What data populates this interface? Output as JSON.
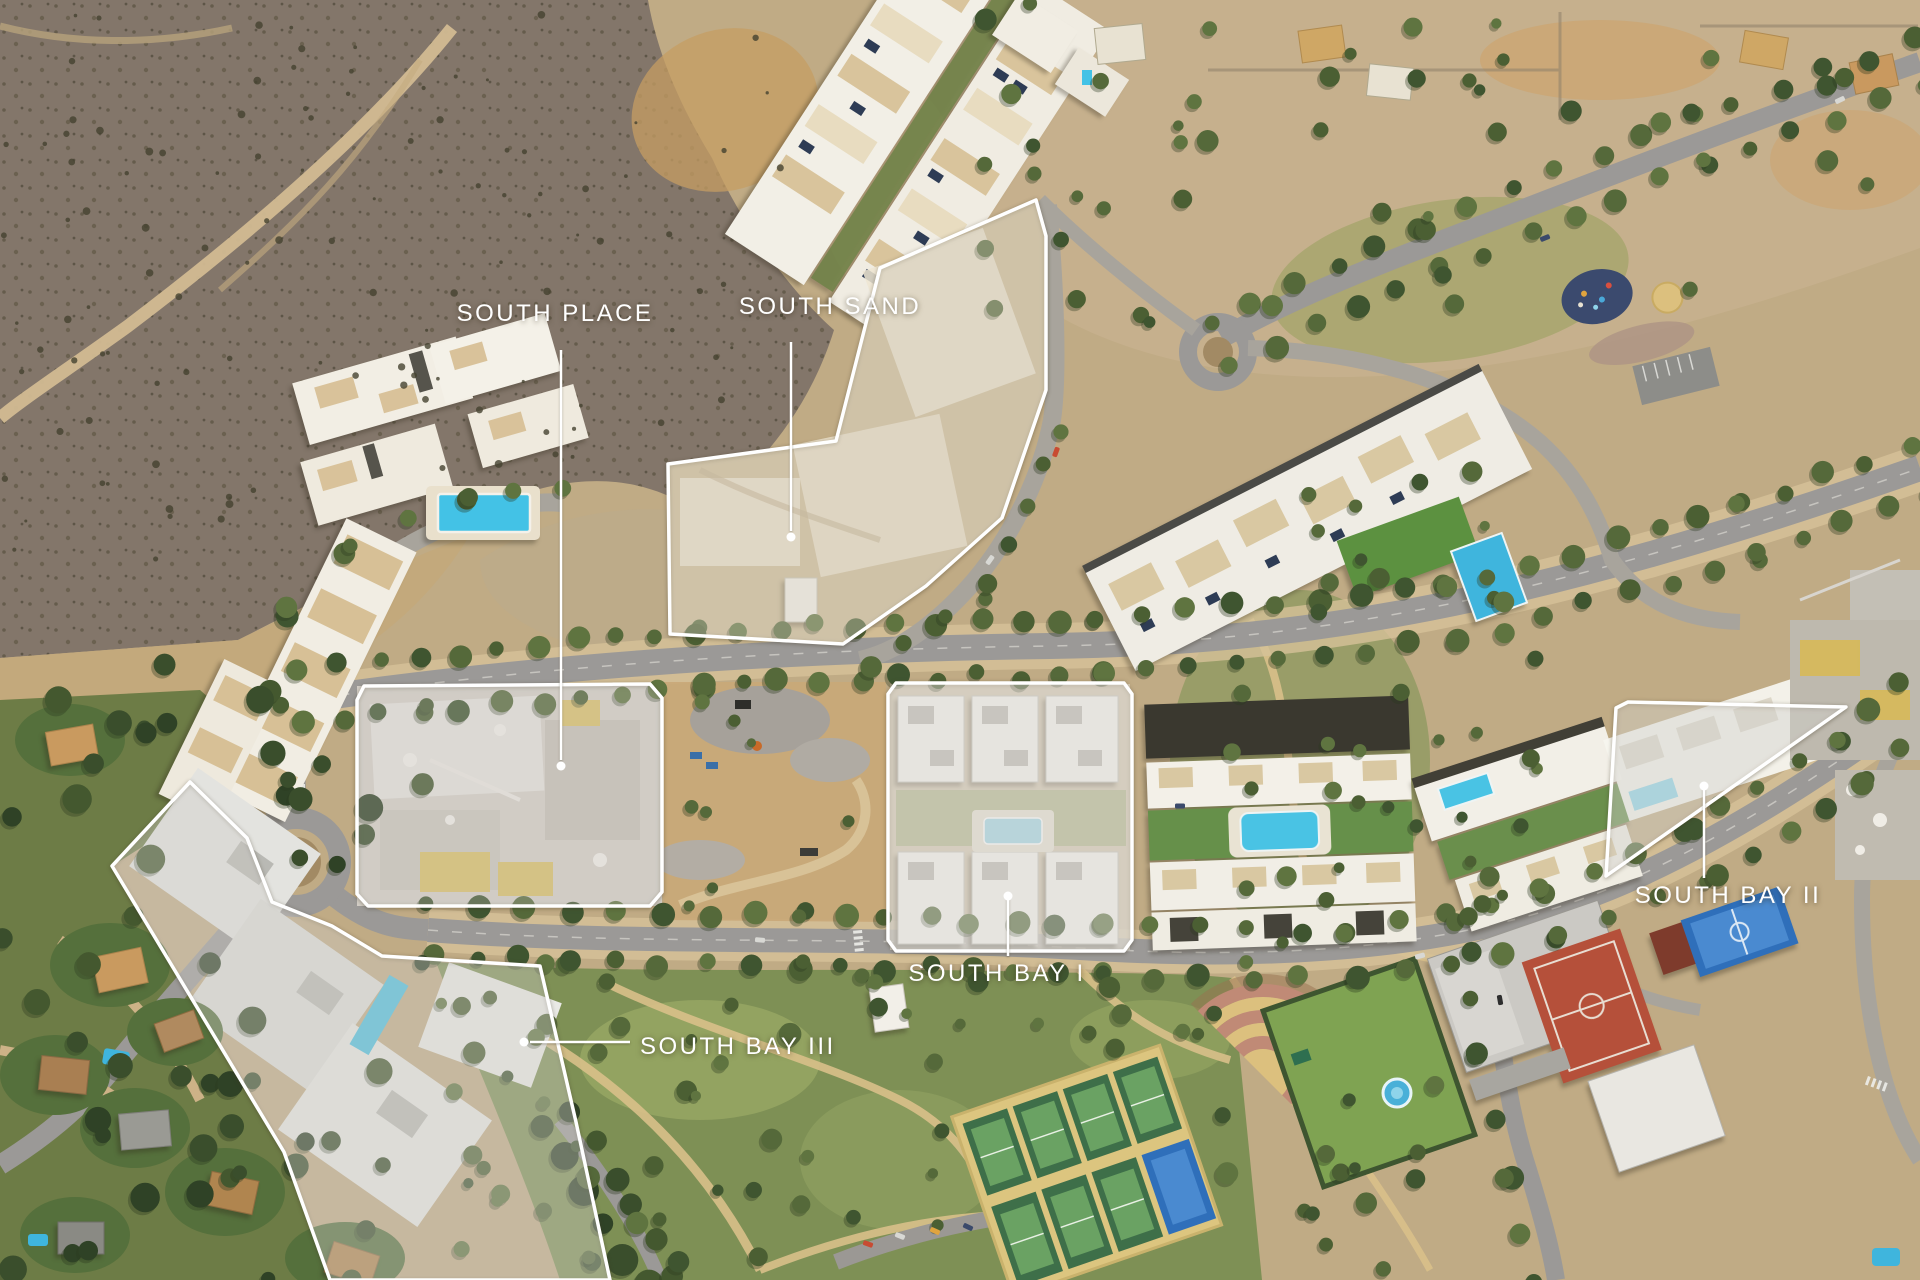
{
  "parcels": [
    {
      "id": "south-place",
      "name": "SOUTH PLACE",
      "label": {
        "x": 555,
        "y": 321,
        "anchor": "middle"
      },
      "leader": {
        "line": [
          [
            561,
            350
          ],
          [
            561,
            760
          ]
        ],
        "dot": [
          561,
          766
        ]
      },
      "outline": "357,700 364,686 650,684 662,698 662,892 650,906 368,906 357,894",
      "fill": "rgba(255,255,255,0.22)"
    },
    {
      "id": "south-sand",
      "name": "SOUTH SAND",
      "label": {
        "x": 830,
        "y": 314,
        "anchor": "middle"
      },
      "leader": {
        "line": [
          [
            791,
            342
          ],
          [
            791,
            531
          ]
        ],
        "dot": [
          791,
          537
        ]
      },
      "outline": "880,268 1036,200 1046,236 1046,390 1002,518 926,586 843,644 670,634 668,464 836,441",
      "fill": "rgba(255,252,242,0.30)"
    },
    {
      "id": "south-bay-1",
      "name": "SOUTH BAY I",
      "label": {
        "x": 997,
        "y": 981,
        "anchor": "middle"
      },
      "leader": {
        "line": [
          [
            1008,
            898
          ],
          [
            1008,
            956
          ]
        ],
        "dot": [
          1008,
          896
        ]
      },
      "outline": "888,694 896,683 1124,683 1132,694 1132,940 1124,951 896,951 888,940",
      "fill": "rgba(255,255,255,0.38)"
    },
    {
      "id": "south-bay-2",
      "name": "SOUTH BAY II",
      "label": {
        "x": 1728,
        "y": 903,
        "anchor": "middle"
      },
      "leader": {
        "line": [
          [
            1704,
            788
          ],
          [
            1704,
            878
          ]
        ],
        "dot": [
          1704,
          786
        ]
      },
      "outline": "1606,876 1616,708 1628,702 1846,707",
      "fill": "rgba(255,255,255,0.34)"
    },
    {
      "id": "south-bay-3",
      "name": "SOUTH BAY III",
      "label": {
        "x": 640,
        "y": 1054,
        "anchor": "start"
      },
      "leader": {
        "line": [
          [
            530,
            1042
          ],
          [
            630,
            1042
          ]
        ],
        "dot": [
          524,
          1042
        ]
      },
      "outline": "190,782 247,838 272,902 332,926 382,956 540,966 576,1122 610,1280 330,1280 284,1152 112,866",
      "fill": "rgba(255,255,255,0.30)"
    }
  ],
  "style": {
    "outline_color": "#ffffff",
    "label_color": "#ffffff",
    "label_font_size": 24,
    "letter_spacing": 2.5,
    "leader_width": 2.5,
    "dot_radius": 4.5,
    "parcel_fill": "rgba(255,255,255,0.3)"
  },
  "palette": {
    "overlay_white": "#ffffff",
    "pool_water": "#43c2e6",
    "vegetation": "#55693a",
    "terrain_scrub": "#83766a",
    "terrain_sand": "#c9b28c",
    "road_asphalt": "#9b9997",
    "path_tan": "#d9c493",
    "building_white": "#f2efe7",
    "roof_beige": "#d9c29a",
    "solar_panel": "#2e3c55",
    "court_red": "#b5503a",
    "court_blue": "#2f6fba",
    "court_green": "#6aa263",
    "amphitheater_rose": "#c08a76",
    "amphitheater_sand": "#dcc07e",
    "construction_yellow": "#d9bf62"
  }
}
